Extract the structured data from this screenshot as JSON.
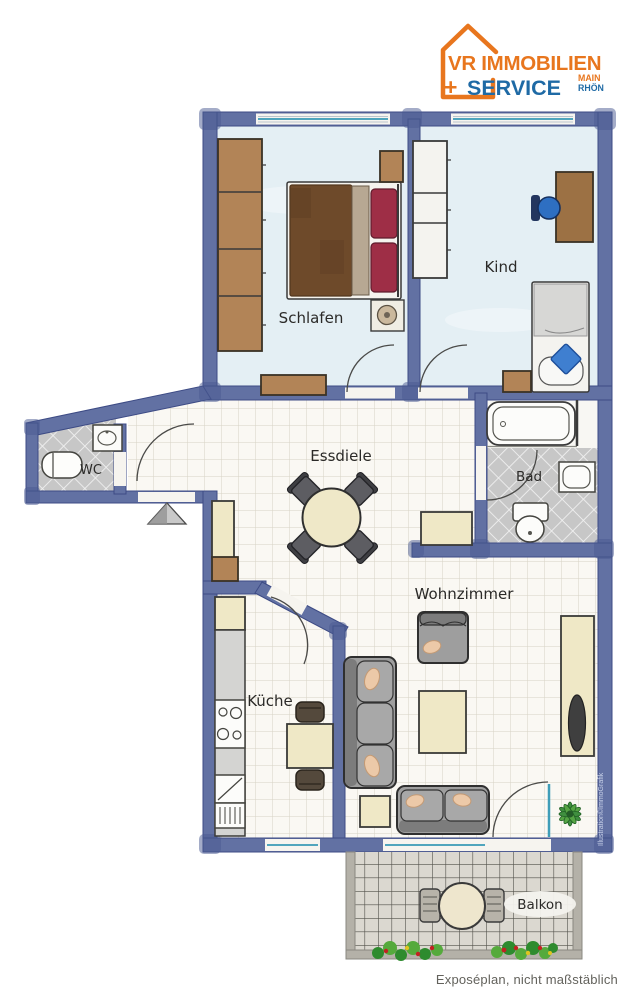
{
  "logo": {
    "brand_line1": "VR IMMOBILIEN",
    "plus_sign": "+",
    "brand_line2": "SERVICE",
    "region_line1": "MAIN",
    "region_line2": "RHÖN"
  },
  "rooms": {
    "schlafen": "Schlafen",
    "kind": "Kind",
    "wc": "WC",
    "essdiele": "Essdiele",
    "bad": "Bad",
    "kueche": "Küche",
    "wohnzimmer": "Wohnzimmer",
    "balkon": "Balkon"
  },
  "annotations": {
    "watermark": "Illustration©ImmoGrafik",
    "disclaimer": "Exposéplan, nicht maßstäblich"
  },
  "colors": {
    "brand_orange": "#e8761e",
    "brand_blue": "#1f6aa5",
    "wall_blue": "#6271a3",
    "wall_edge": "#3d4b85",
    "bedroom_floor": "#e4eff4",
    "tile_floor": "#faf8f3",
    "wet_floor": "#c7c7c7",
    "balcony_floor": "#dbd8d0",
    "window_teal": "#3f9db8",
    "wood_brown": "#b28457",
    "cream_furniture": "#efe8c6",
    "sofa_grey": "#9e9e9e",
    "pillow_peach": "#ecc9a8",
    "bed_brown": "#6e4a2a",
    "pillow_red": "#9e2e46",
    "chair_blue": "#2e6fc2",
    "plant_green": "#3f8f3f"
  }
}
